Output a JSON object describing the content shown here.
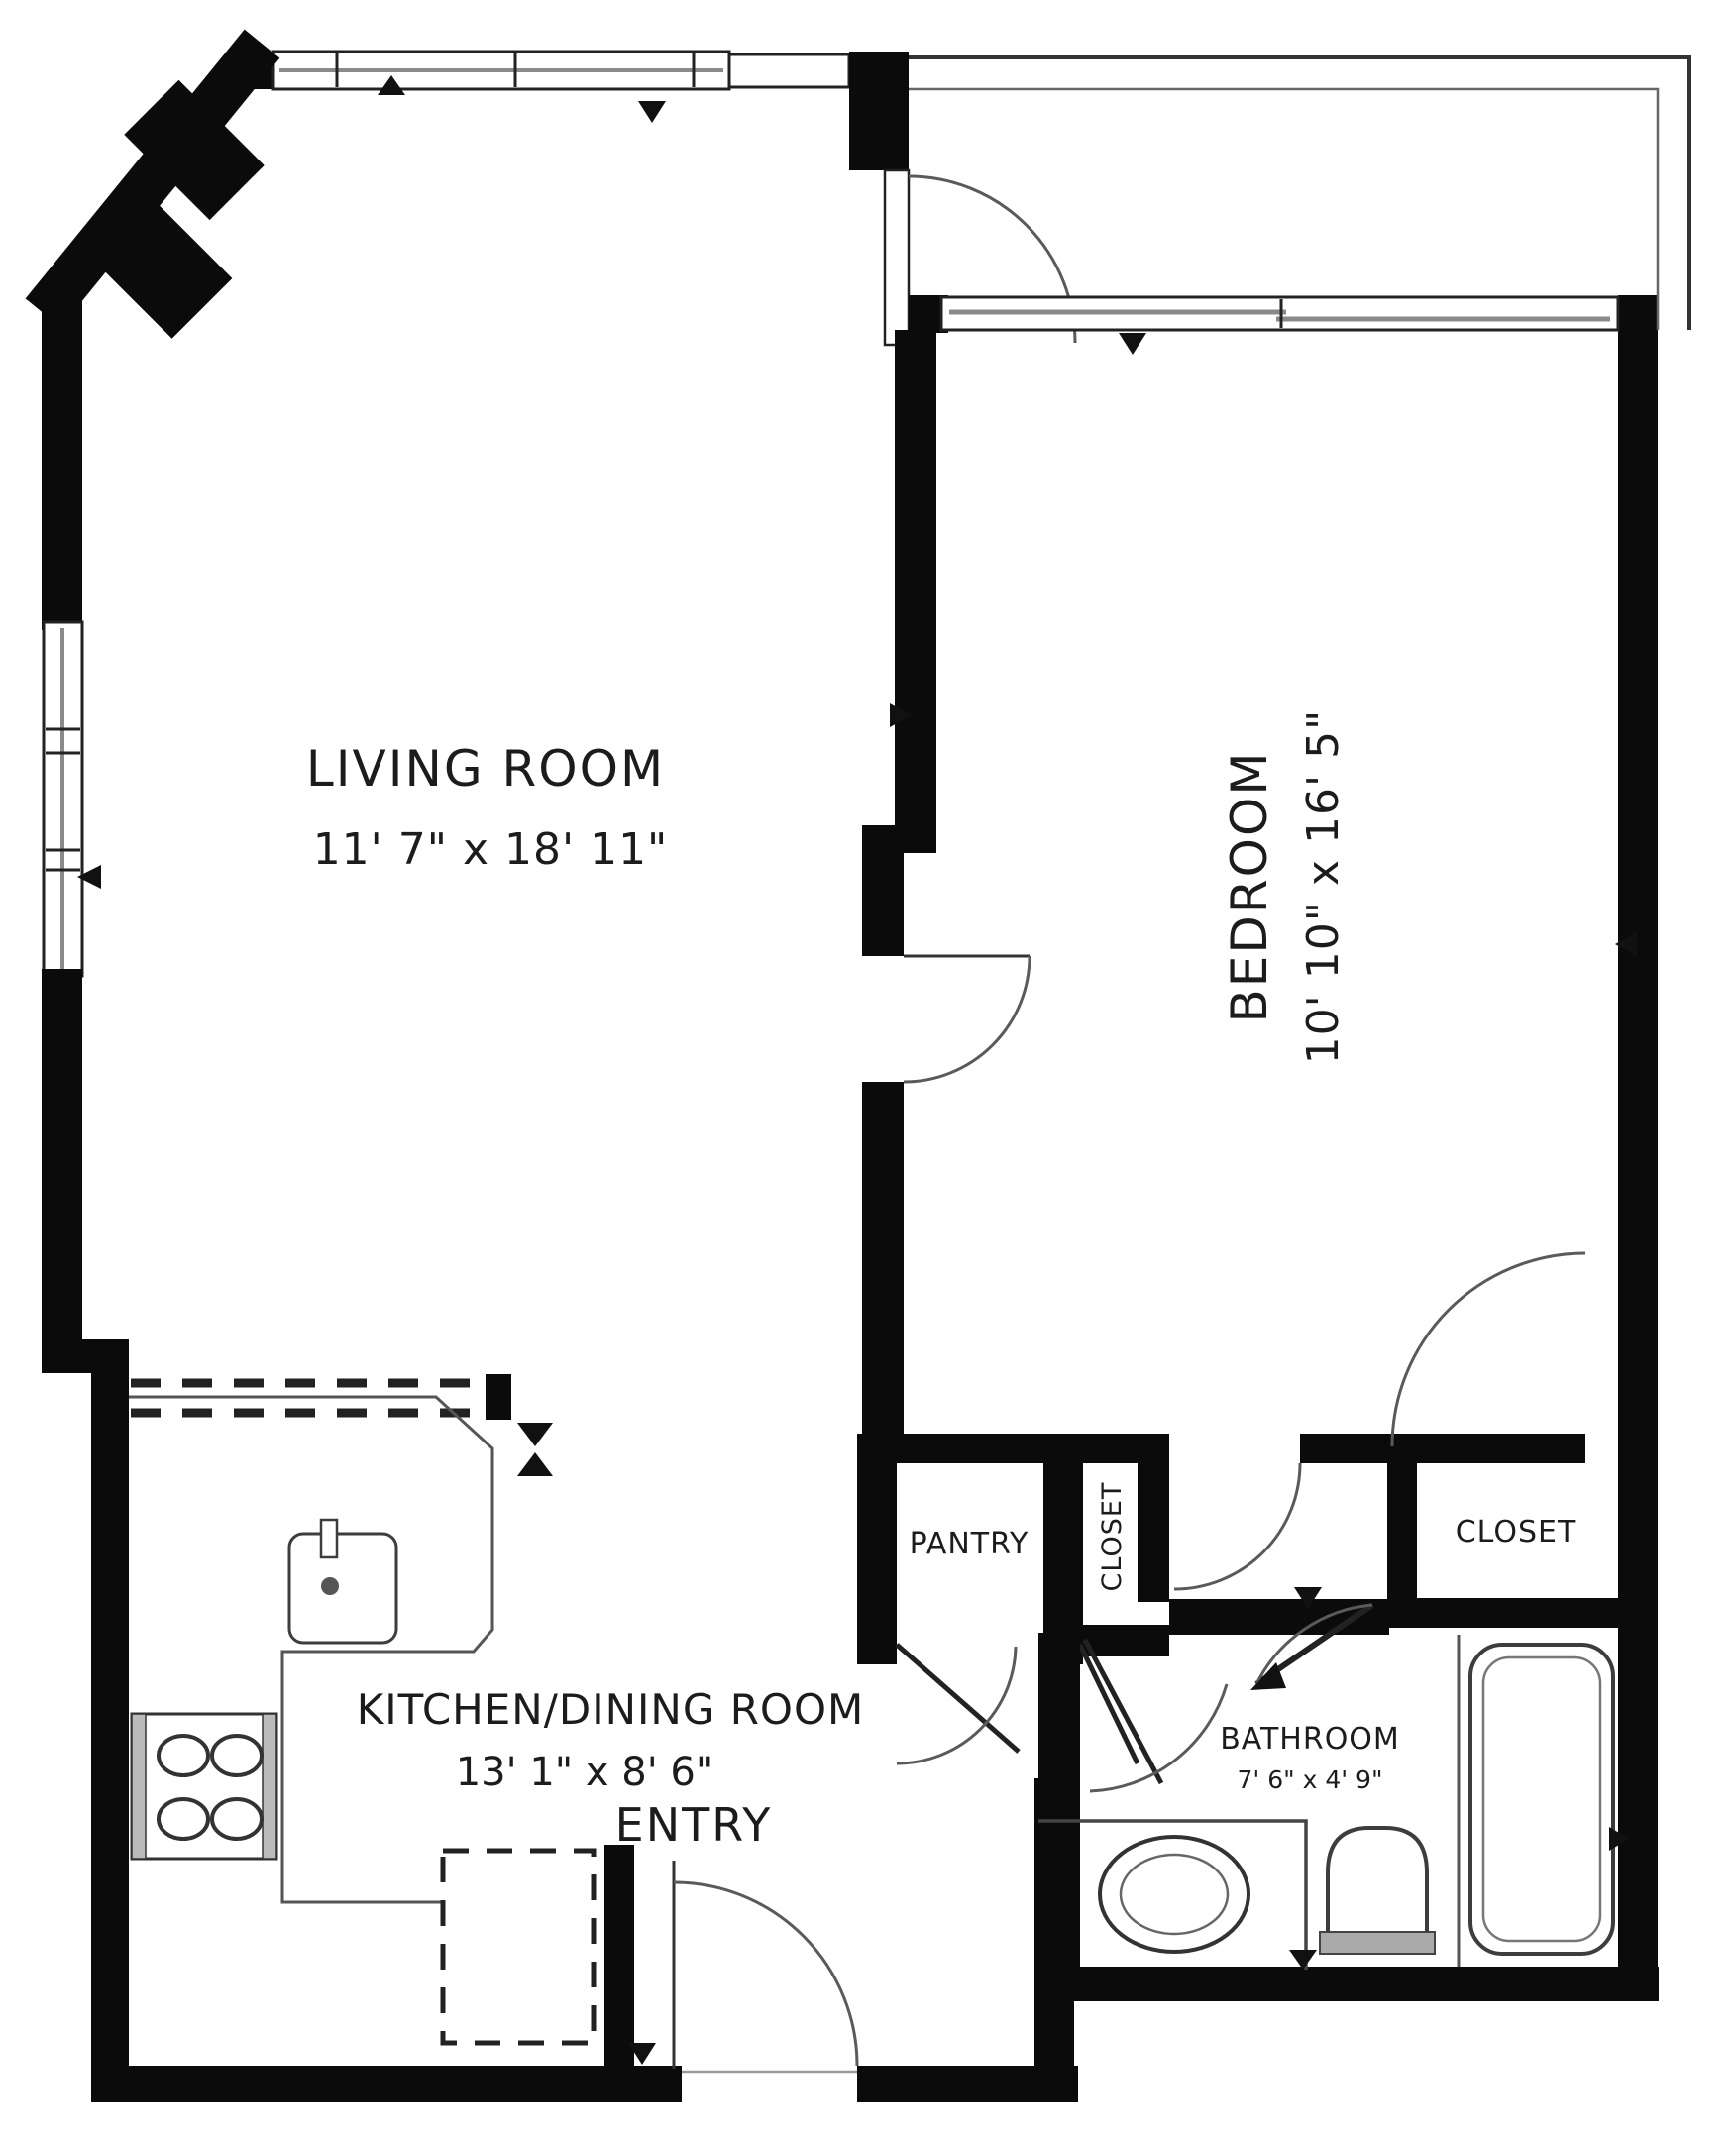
{
  "rooms": {
    "living_room": {
      "name": "LIVING ROOM",
      "dims": "11' 7\" x 18' 11\""
    },
    "bedroom": {
      "name": "BEDROOM",
      "dims": "10' 10\" x 16' 5\""
    },
    "kitchen": {
      "name": "KITCHEN/DINING ROOM",
      "dims": "13' 1\" x 8' 6\""
    },
    "entry": {
      "name": "ENTRY"
    },
    "pantry": {
      "name": "PANTRY"
    },
    "closet_hall": {
      "name": "CLOSET"
    },
    "closet_bedroom": {
      "name": "CLOSET"
    },
    "bathroom": {
      "name": "BATHROOM",
      "dims": "7' 6\" x 4' 9\""
    }
  },
  "palette": {
    "wall": "#0b0b0b",
    "line": "#555555",
    "window": "#8a8a8a",
    "text": "#1c1c1c",
    "background": "#ffffff"
  }
}
